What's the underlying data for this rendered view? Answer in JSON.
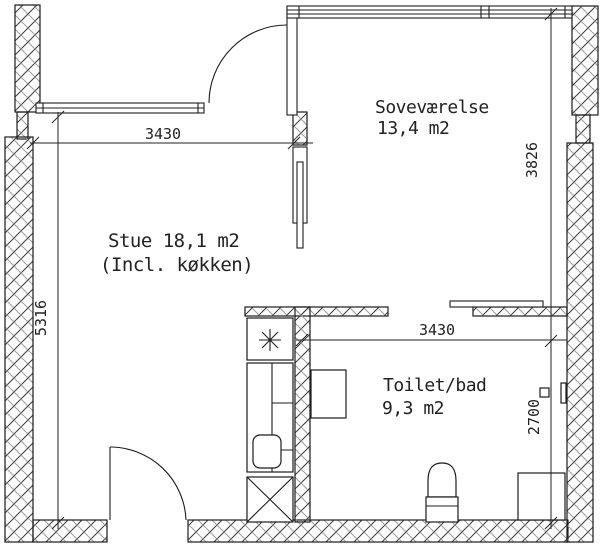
{
  "drawing": {
    "type": "floor-plan",
    "rooms": {
      "bedroom": {
        "name": "Soveværelse",
        "area": "13,4 m2"
      },
      "living": {
        "name_area": "Stue 18,1 m2",
        "note": "(Incl. køkken)"
      },
      "bath": {
        "name": "Toilet/bad",
        "area": "9,3 m2"
      }
    },
    "dimensions": {
      "living_width": "3430",
      "living_depth": "5316",
      "bedroom_depth": "3826",
      "bath_width": "3430",
      "bath_depth": "2700"
    },
    "colors": {
      "line": "#1c1c1c",
      "hatch_dark": "#3a3a3a",
      "hatch_light": "#9a9a9a",
      "background": "#ffffff"
    }
  }
}
